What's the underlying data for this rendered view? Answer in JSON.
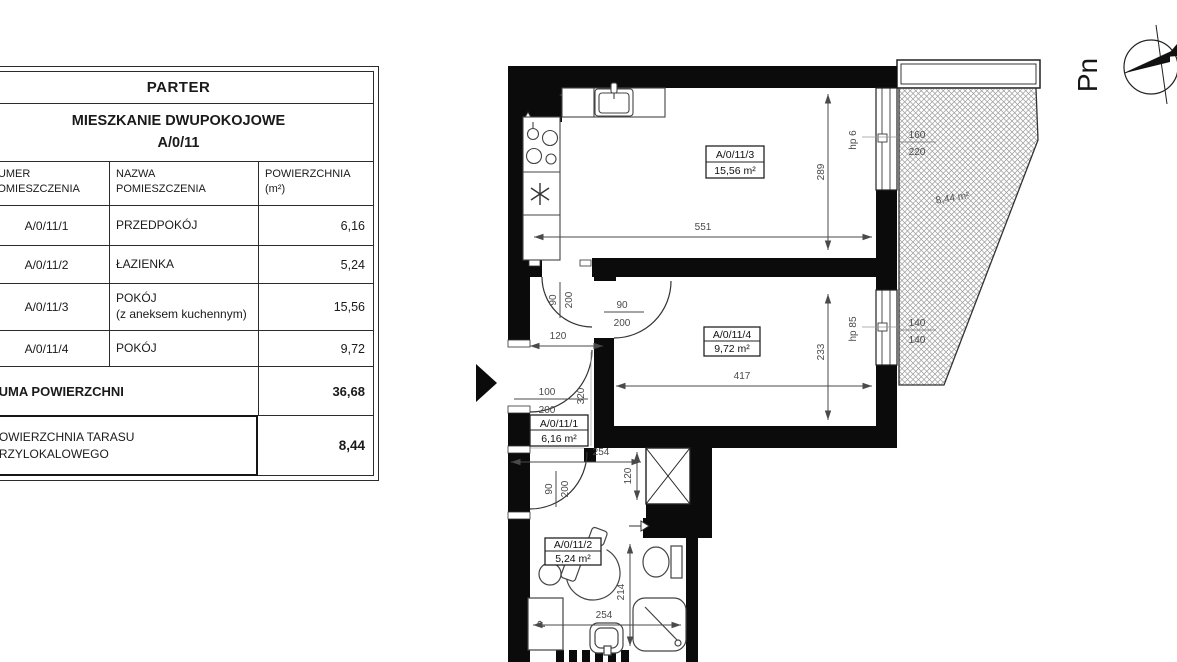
{
  "table": {
    "title": "PARTER",
    "subtitle_line1": "MIESZKANIE DWUPOKOJOWE",
    "subtitle_line2": "A/0/11",
    "col_headers": {
      "number": "NUMER\nPOMIESZCZENIA",
      "name": "NAZWA\nPOMIESZCZENIA",
      "area": "POWIERZCHNIA\n(m²)"
    },
    "rows": [
      {
        "no": "A/0/11/1",
        "name": "PRZEDPOKÓJ",
        "area": "6,16"
      },
      {
        "no": "A/0/11/2",
        "name": "ŁAZIENKA",
        "area": "5,24"
      },
      {
        "no": "A/0/11/3",
        "name": "POKÓJ\n(z aneksem kuchennym)",
        "area": "15,56"
      },
      {
        "no": "A/0/11/4",
        "name": "POKÓJ",
        "area": "9,72"
      }
    ],
    "sum_label": "SUMA POWIERZCHNI",
    "sum_value": "36,68",
    "terrace_label": "POWIERZCHNIA TARASU\nPRZYLOKALOWEGO",
    "terrace_value": "8,44"
  },
  "plan": {
    "rooms": {
      "living": {
        "id": "A/0/11/3",
        "area": "15,56 m²"
      },
      "bedroom": {
        "id": "A/0/11/4",
        "area": "9,72 m²"
      },
      "hall": {
        "id": "A/0/11/1",
        "area": "6,16 m²"
      },
      "bath": {
        "id": "A/0/11/2",
        "area": "5,24 m²"
      }
    },
    "terrace_area": "8,44 m²",
    "dims": {
      "kitchen_width": "551",
      "kitchen_height": "289",
      "room4_width": "417",
      "room4_height": "233",
      "hall_width": "120",
      "hall_depth": "320",
      "corridor_width": "254",
      "shaft_depth": "120",
      "bath_depth": "214",
      "bath_width": "254"
    },
    "windows": {
      "w1_label": "hp 6",
      "w1_top": "160",
      "w1_bottom": "220",
      "w2_label": "hp 85",
      "w2_top": "140",
      "w2_bottom": "140"
    },
    "doors": {
      "hall_kitchen": {
        "w": "90",
        "h": "200"
      },
      "room4": {
        "w": "90",
        "h": "200"
      },
      "entrance": {
        "w": "100",
        "h": "200"
      },
      "bath": {
        "w": "90",
        "h": "200"
      }
    },
    "washer_label": "P",
    "compass_label": "Pn"
  }
}
